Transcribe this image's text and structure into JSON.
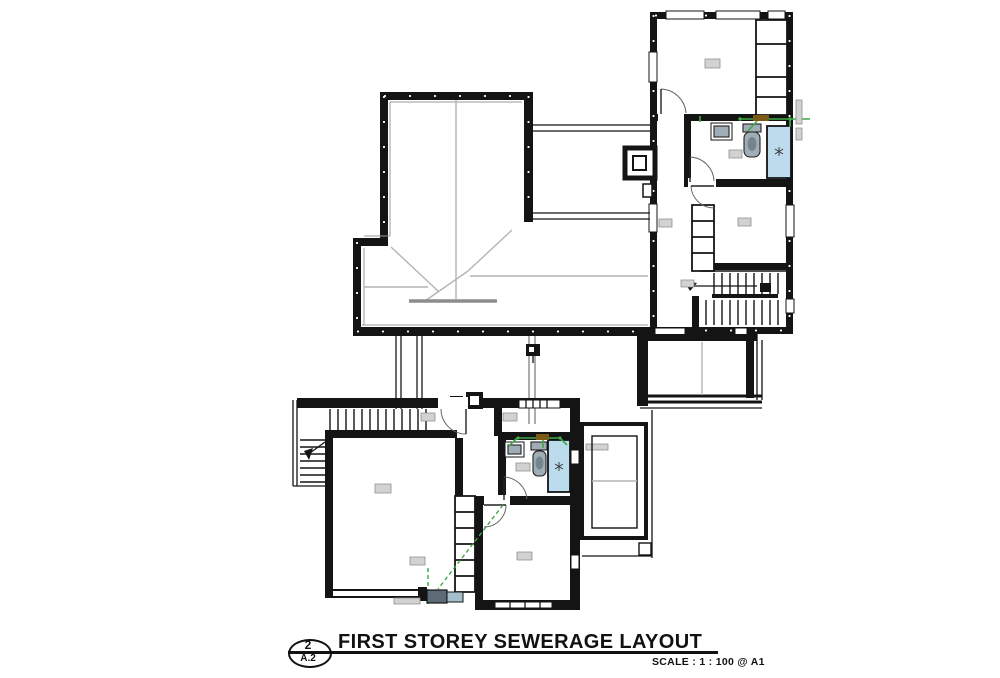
{
  "colors": {
    "wall": "#141414",
    "ridge": "#b4b4b4",
    "pipe-green": "#3faa45",
    "fitting-brown": "#7a5a14",
    "shower-blue": "#bcdcee",
    "fixture-grey": "#9fadb6",
    "tag-fill": "#d2d2d2"
  },
  "title_block": {
    "detail_number": "2",
    "sheet_ref": "A.2",
    "title": "FIRST STOREY SEWERAGE LAYOUT",
    "scale_label": "SCALE : 1 : 100 @ A1"
  },
  "plan": {
    "drawing_type": "first-storey sewerage layout floor plan",
    "areas": [
      "hip-roof-plan",
      "upper-annex-rooms",
      "annex-balcony-terrace",
      "lower-wing-rooms",
      "porch-canopy"
    ],
    "fixtures": [
      "wash-basin",
      "wc-pan",
      "shower-tray",
      "floor-gully",
      "built-in-wardrobe",
      "dog-leg-staircase",
      "external-stair",
      "sewer-pipe-runs",
      "roof-outlet"
    ],
    "room_tags_legible": false
  }
}
